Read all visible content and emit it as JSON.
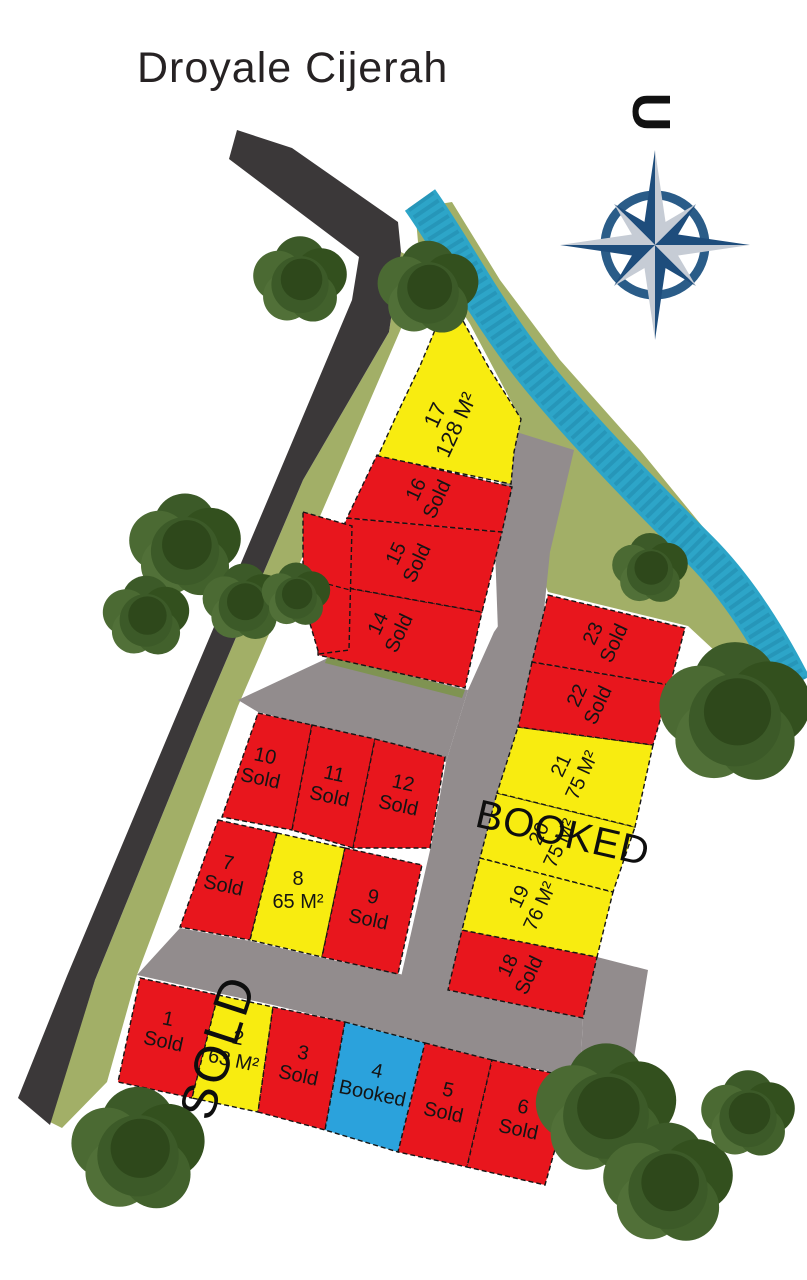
{
  "title": "Droyale Cijerah",
  "compass": {
    "north_label": "U"
  },
  "overlays": {
    "booked": "BOOKED",
    "sold": "SOLD"
  },
  "colors": {
    "sold": "#e8161d",
    "available": "#f8ec10",
    "booked": "#2ba2dc",
    "road_dark": "#3b3839",
    "road_gray": "#928c8d",
    "green": "#a2af67",
    "water": "#2da5c8",
    "tree": "#46642f",
    "compass_dark": "#1e4d7c",
    "compass_light": "#c6ccd5"
  },
  "lots": [
    {
      "number": "1",
      "status": "sold",
      "label": "Sold",
      "points": "140,978 218,995 192,1098 118,1082",
      "tx": 165,
      "ty": 1034,
      "rot": 12
    },
    {
      "number": "2",
      "status": "available",
      "label": "63 M²",
      "points": "218,995 273,1007 258,1112 192,1098",
      "tx": 235,
      "ty": 1053,
      "rot": 12
    },
    {
      "number": "3",
      "status": "sold",
      "label": "Sold",
      "points": "273,1007 345,1022 325,1130 258,1112",
      "tx": 300,
      "ty": 1068,
      "rot": 12
    },
    {
      "number": "4",
      "status": "booked",
      "label": "Booked",
      "points": "345,1022 425,1043 398,1152 325,1130",
      "tx": 374,
      "ty": 1086,
      "rot": 12
    },
    {
      "number": "5",
      "status": "sold",
      "label": "Sold",
      "points": "425,1043 492,1060 467,1167 398,1152",
      "tx": 445,
      "ty": 1105,
      "rot": 12
    },
    {
      "number": "6",
      "status": "sold",
      "label": "Sold",
      "points": "492,1060 575,1078 545,1185 467,1167",
      "tx": 520,
      "ty": 1122,
      "rot": 12
    },
    {
      "number": "7",
      "status": "sold",
      "label": "Sold",
      "points": "218,820 277,833 250,940 180,927",
      "tx": 225,
      "ty": 878,
      "rot": 12
    },
    {
      "number": "8",
      "status": "available",
      "label": "65 M²",
      "points": "277,833 345,848 322,957 250,940",
      "tx": 298,
      "ty": 894,
      "rot": 0
    },
    {
      "number": "9",
      "status": "sold",
      "label": "Sold",
      "points": "345,848 422,865 398,974 322,957",
      "tx": 370,
      "ty": 912,
      "rot": 12
    },
    {
      "number": "10",
      "status": "sold",
      "label": "Sold",
      "points": "258,713 312,725 292,830 222,817",
      "tx": 262,
      "ty": 771,
      "rot": 12
    },
    {
      "number": "11",
      "status": "sold",
      "label": "Sold",
      "points": "312,725 375,739 353,848 292,830",
      "tx": 331,
      "ty": 789,
      "rot": 12
    },
    {
      "number": "12",
      "status": "sold",
      "label": "Sold",
      "points": "375,739 445,757 430,848 353,848",
      "tx": 400,
      "ty": 798,
      "rot": 12
    },
    {
      "number": "14",
      "status": "sold",
      "label": "Sold",
      "points": "320,583 482,612 465,688 318,655",
      "tx": 392,
      "ty": 630,
      "rot": -65
    },
    {
      "number": "15",
      "status": "sold",
      "label": "Sold",
      "points": "347,518 502,532 482,612 320,583",
      "tx": 410,
      "ty": 560,
      "rot": -65
    },
    {
      "number": "16",
      "status": "sold",
      "label": "Sold",
      "points": "377,455 512,487 502,532 347,518",
      "tx": 430,
      "ty": 496,
      "rot": -65
    },
    {
      "number": "17",
      "status": "available",
      "label": "128 M²",
      "points": "448,293 468,330 489,368 508,398 521,419 514,452 511,484 378,456 398,412 420,366 435,330",
      "tx": 450,
      "ty": 422,
      "rot": -65,
      "size": 22
    },
    {
      "number": "18",
      "status": "sold",
      "label": "Sold",
      "points": "462,930 597,957 583,1018 448,990",
      "tx": 522,
      "ty": 972,
      "rot": -65
    },
    {
      "number": "19",
      "status": "available",
      "label": "76 M²",
      "points": "480,858 613,892 597,957 462,930",
      "tx": 533,
      "ty": 903,
      "rot": -65
    },
    {
      "number": "20",
      "status": "available",
      "label": "75 M²",
      "points": "497,793 635,827 613,892 480,858",
      "tx": 553,
      "ty": 840,
      "rot": -65
    },
    {
      "number": "21",
      "status": "available",
      "label": "75 M²",
      "points": "518,727 653,745 635,827 497,793",
      "tx": 575,
      "ty": 772,
      "rot": -65
    },
    {
      "number": "22",
      "status": "sold",
      "label": "Sold",
      "points": "532,662 670,685 653,745 518,727",
      "tx": 591,
      "ty": 702,
      "rot": -65
    },
    {
      "number": "23",
      "status": "sold",
      "label": "Sold",
      "points": "548,595 685,628 670,685 532,662",
      "tx": 607,
      "ty": 640,
      "rot": -65
    },
    {
      "number": "",
      "status": "sold",
      "label": "",
      "points": "303,512 352,526 349,650 319,654 303,600",
      "tx": 0,
      "ty": 0,
      "rot": 0
    }
  ]
}
